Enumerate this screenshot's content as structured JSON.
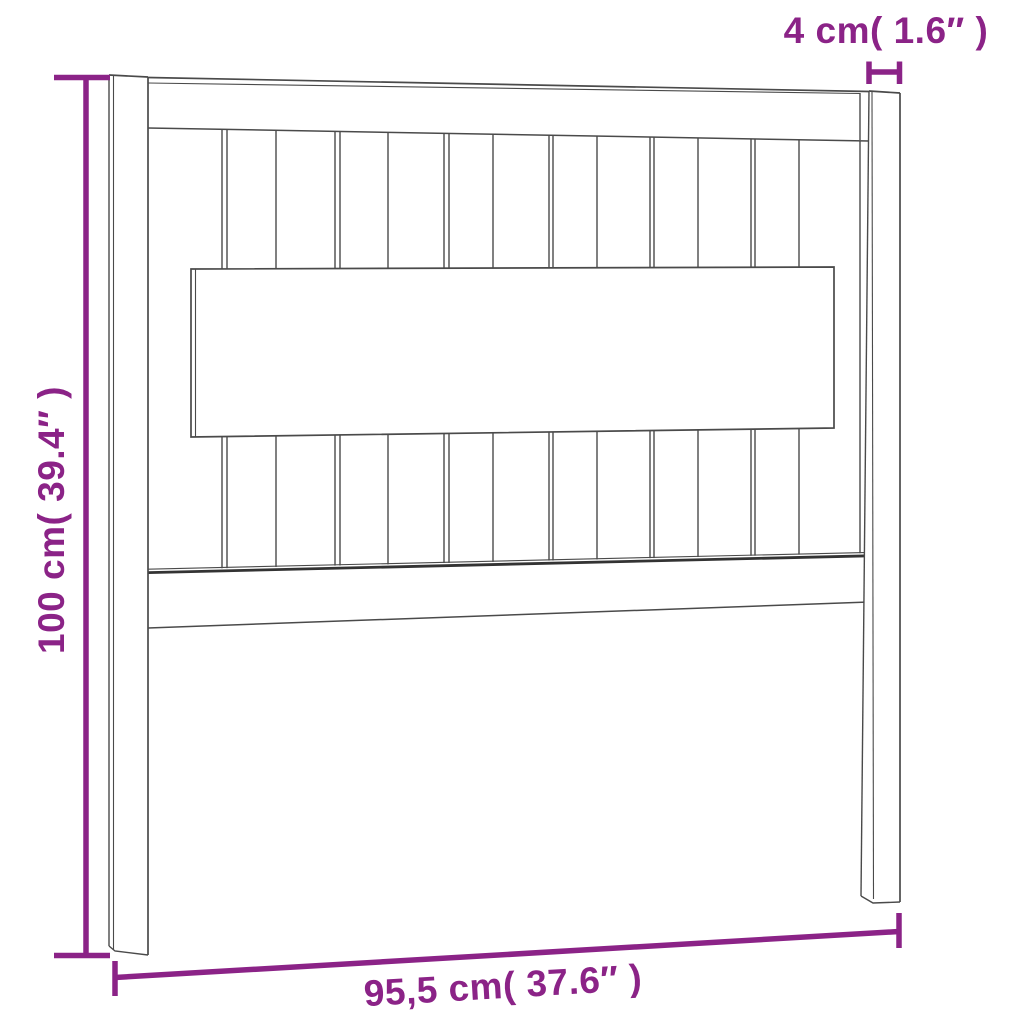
{
  "colors": {
    "dimension": "#8b2387",
    "outline": "#4a4a4a",
    "outline_dark": "#333333",
    "background": "#ffffff"
  },
  "labels": {
    "top_width": "4 cm( 1.6″ )",
    "left_height": "100 cm( 39.4″ )",
    "bottom_width": "95,5 cm( 37.6″ )"
  },
  "measurements": {
    "post_thickness_cm": "4",
    "post_thickness_in": "1.6",
    "height_cm": "100",
    "height_in": "39.4",
    "width_cm": "95,5",
    "width_in": "37.6"
  }
}
